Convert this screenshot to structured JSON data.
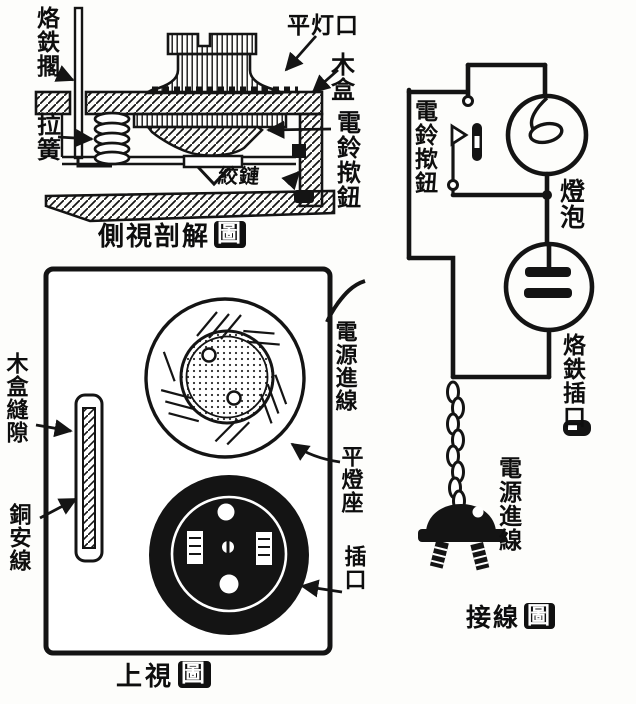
{
  "page": {
    "ink_color": "#121212",
    "paper_color": "#fdfdfb",
    "description_names": [
      "side-cutaway-diagram",
      "top-view-diagram",
      "wiring-diagram"
    ]
  },
  "side_view": {
    "caption_main": "側視剖解",
    "caption_badge": "圖",
    "labels": {
      "iron_rest": "烙鉄擱",
      "pull_spring": "拉簧",
      "flat_lamp_socket": "平灯口",
      "wood_box": "木盒",
      "bell_button": "電鈴揿鈕",
      "hinge": "絞鏈"
    }
  },
  "top_view": {
    "caption_main": "上視",
    "caption_badge": "圖",
    "labels": {
      "box_slit": "木盒縫隙",
      "copper_strip": "銅安線",
      "power_inlet": "電源進線",
      "lamp_holder": "平燈座",
      "socket": "插口"
    }
  },
  "wiring": {
    "caption_main": "接線",
    "caption_badge": "圖",
    "labels": {
      "bell_button": "電鈴揿鈕",
      "bulb": "燈泡",
      "iron_socket": "烙鉄插口",
      "power_cord": "電源進線"
    }
  }
}
